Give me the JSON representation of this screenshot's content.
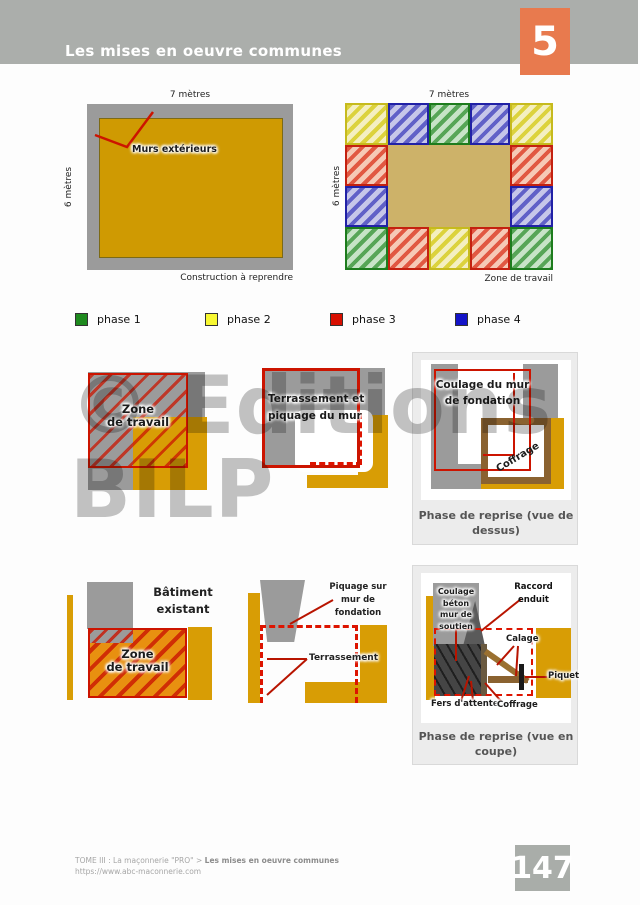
{
  "header": {
    "title": "Les mises en oeuvre communes",
    "chapter": "5",
    "accent": "#e87a4e"
  },
  "plan_left": {
    "dim_top": "7 mètres",
    "dim_side": "6 mètres",
    "callout": "Murs extérieurs",
    "caption": "Construction à reprendre"
  },
  "plan_right": {
    "dim_top": "7 mètres",
    "dim_side": "6 mètres",
    "caption": "Zone de travail"
  },
  "legend": [
    {
      "label": "phase 1",
      "color": "#1e8a1e"
    },
    {
      "label": "phase 2",
      "color": "#f8f832"
    },
    {
      "label": "phase 3",
      "color": "#d80f00"
    },
    {
      "label": "phase 4",
      "color": "#1414c8"
    }
  ],
  "fig_zone": {
    "l1": "Zone",
    "l2": "de travail"
  },
  "fig_terr": {
    "l1": "Terrassement et",
    "l2": "piquage du mur"
  },
  "card_dessus": {
    "l1": "Coulage du mur",
    "l2": "de fondation",
    "coffrage": "Coffrage",
    "cap1": "Phase de reprise (vue de",
    "cap2": "dessus)"
  },
  "fig_bat": {
    "b1": "Bâtiment",
    "b2": "existant",
    "z1": "Zone",
    "z2": "de travail"
  },
  "fig_piq": {
    "p1": "Piquage sur",
    "p2": "mur de",
    "p3": "fondation",
    "terr": "Terrassement"
  },
  "card_coupe": {
    "w1": "Coulage",
    "w2": "béton",
    "w3": "mur de",
    "w4": "soutien",
    "raccord1": "Raccord",
    "raccord2": "enduit",
    "calage": "Calage",
    "piquet": "Piquet",
    "fers": "Fers d'attente",
    "coffrage": "Coffrage",
    "cap1": "Phase de reprise (vue en",
    "cap2": "coupe)"
  },
  "watermark": {
    "l1": "© Editions",
    "l2": "BILP"
  },
  "footer": {
    "crumb": "TOME III : La maçonnerie \"PRO\" > ",
    "crumb_bold": "Les mises en oeuvre communes",
    "url": "https://www.abc-maconnerie.com",
    "page": "147"
  }
}
